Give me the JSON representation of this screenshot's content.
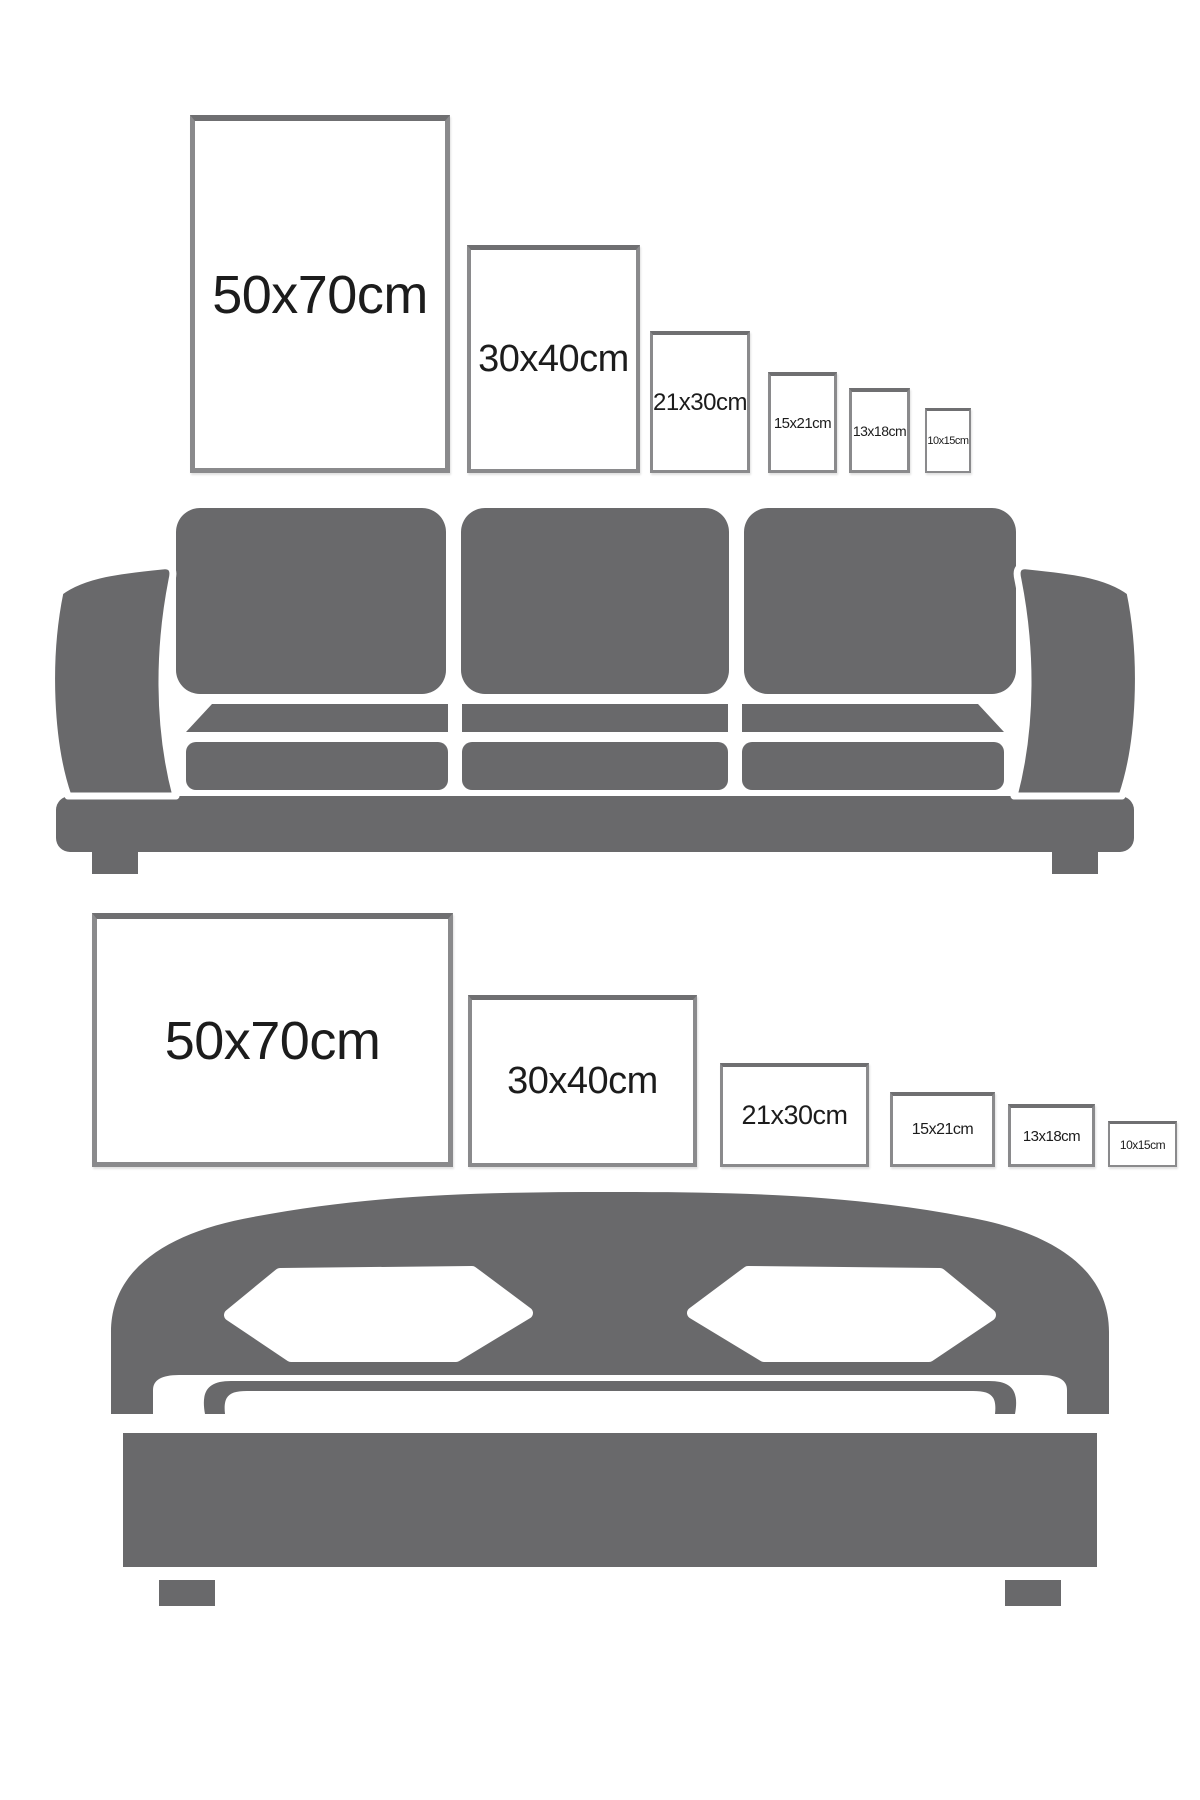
{
  "colors": {
    "furniture": "#69696B",
    "frame_border": "#8A8A8C",
    "frame_border_top": "#6F6F71",
    "label_text": "#1C1C1C",
    "background": "#FFFFFF"
  },
  "sofa_scene": {
    "furniture_icon": "sofa-icon",
    "orientation": "portrait",
    "frames": [
      {
        "label": "50x70cm"
      },
      {
        "label": "30x40cm"
      },
      {
        "label": "21x30cm"
      },
      {
        "label": "15x21cm"
      },
      {
        "label": "13x18cm"
      },
      {
        "label": "10x15cm"
      }
    ]
  },
  "bed_scene": {
    "furniture_icon": "bed-icon",
    "orientation": "landscape",
    "frames": [
      {
        "label": "50x70cm"
      },
      {
        "label": "30x40cm"
      },
      {
        "label": "21x30cm"
      },
      {
        "label": "15x21cm"
      },
      {
        "label": "13x18cm"
      },
      {
        "label": "10x15cm"
      }
    ]
  }
}
